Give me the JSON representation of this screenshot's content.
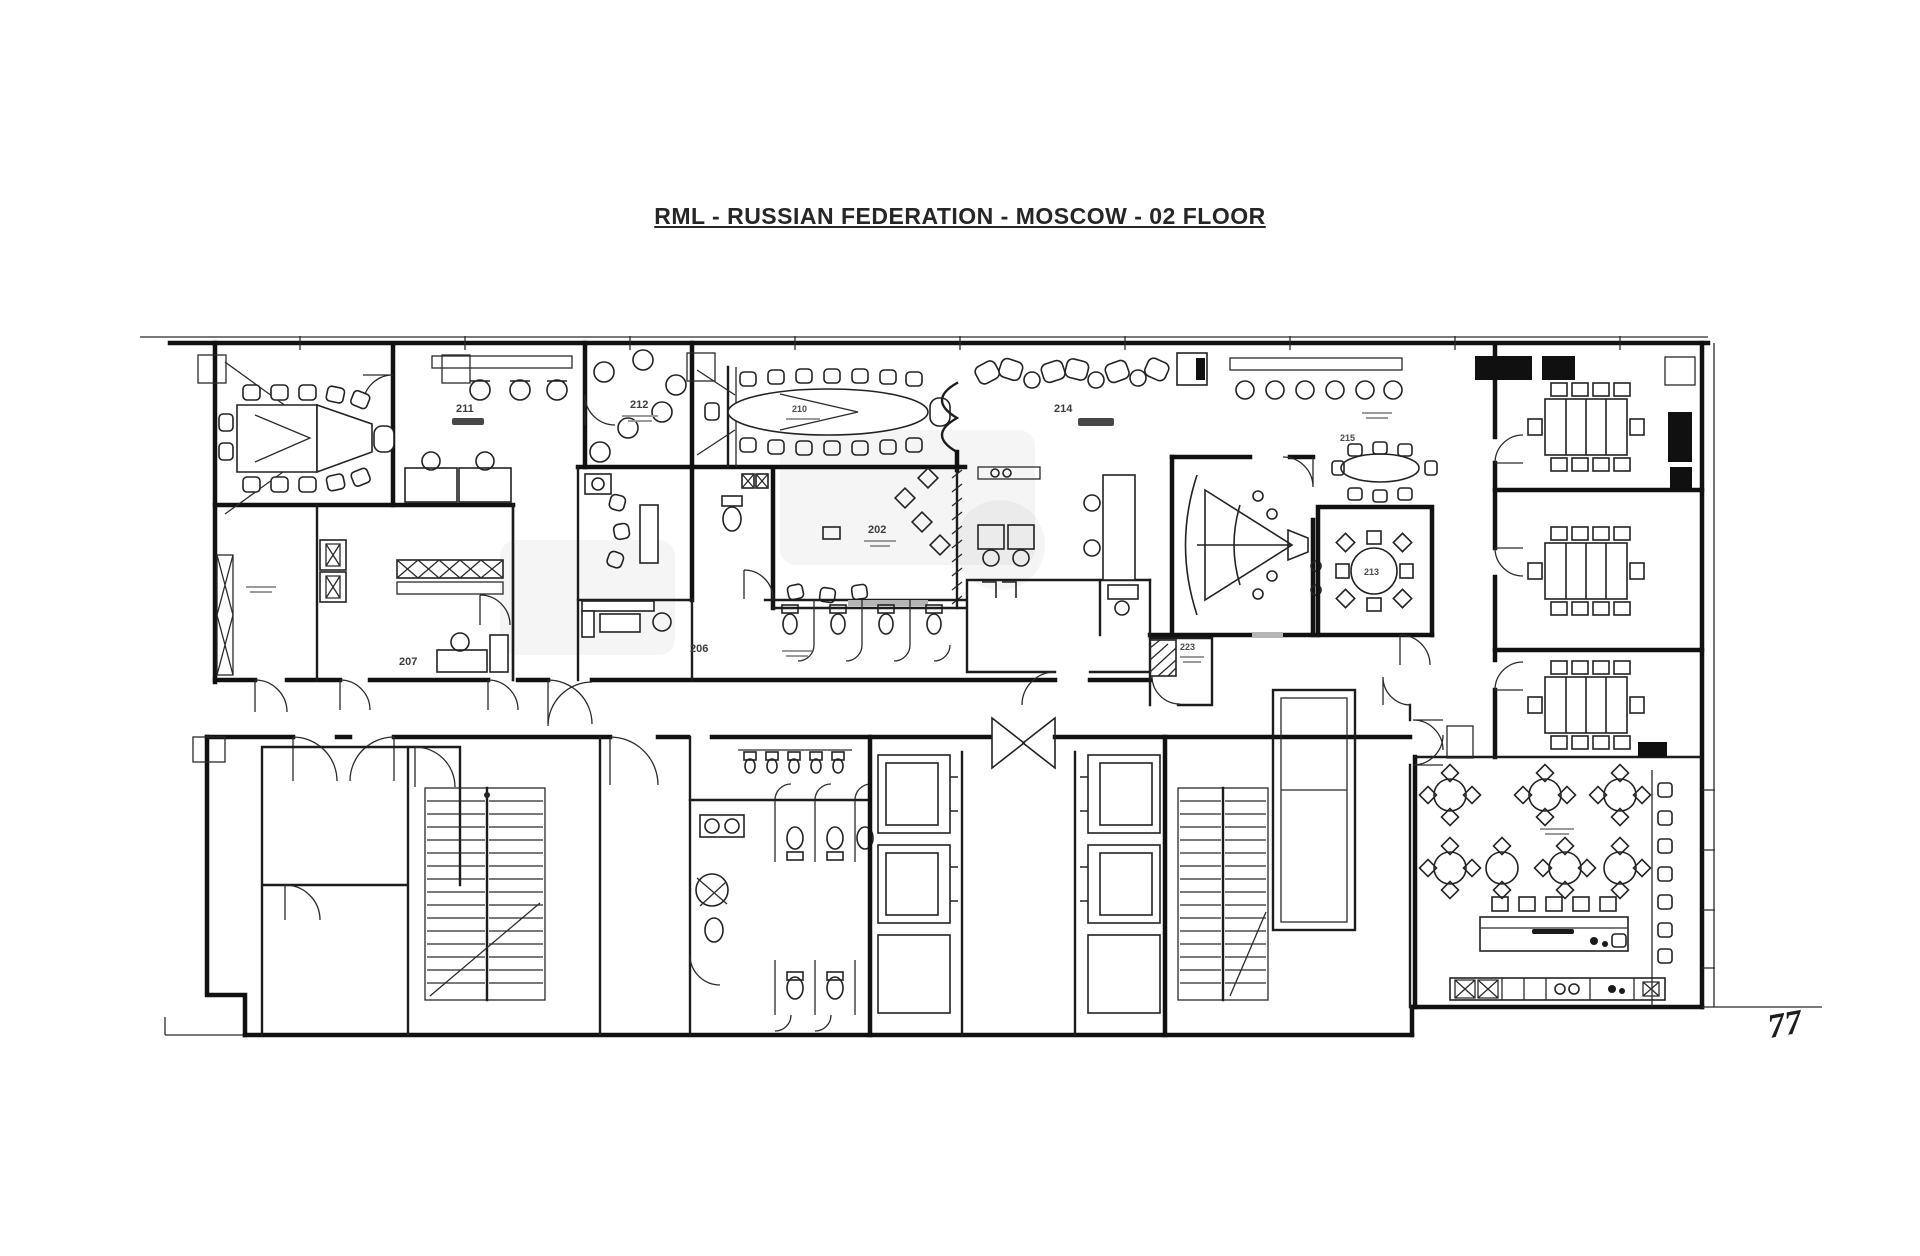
{
  "title": "RML - RUSSIAN FEDERATION - MOSCOW - 02 FLOOR",
  "rooms": {
    "r202": "202",
    "r206": "206",
    "r207": "207",
    "r210": "210",
    "r211": "211",
    "r212": "212",
    "r213": "213",
    "r214": "214",
    "r215": "215",
    "r223": "223"
  },
  "annotations": {
    "section_mark": "77"
  },
  "drawing": {
    "line_color": "#161616",
    "paper_color": "#ffffff"
  }
}
